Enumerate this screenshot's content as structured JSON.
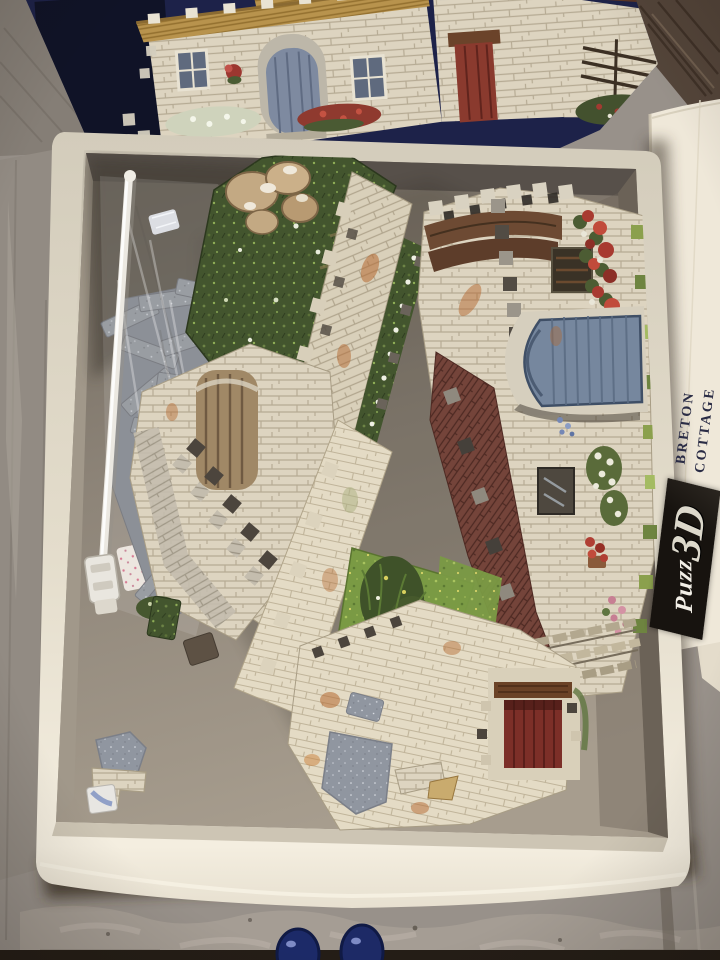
{
  "scene": {
    "description": "Top-down photograph of an opened Puzz 3D 'Breton Cottage' foam jigsaw puzzle box lying on a distressed whitewashed grey wood floor. The dark blue lid with the assembled-cottage artwork lies along the top edge. The open cream box base is filled with part-assembled castellated stone-wall puzzle sections, a clear zip bag of loose grey foam pieces on the left, and scattered pieces; the grey cardboard bottom shows at lower left. A folded instruction sheet rests to the right of the box. Two navy slipper toes peek in at the bottom centre."
  },
  "box": {
    "lid_background_color": "#1c2145",
    "base_rim_color": "#ece5d5",
    "interior_color": "#8e8579",
    "lid_artwork": "white stone Breton cottage with thatched roof, blue arched front door, red side door, shuttered windows, hanging basket and red flower borders on a dark navy background"
  },
  "bag": {
    "description": "clear plastic zip bag with white zip rail and slider, holding loose grey speckled foam pieces"
  },
  "puzzle_pieces": {
    "style": "thick foam 3D pieces with castellated battlement edges",
    "features": [
      "cream stone walls with rust staining",
      "dark green garden with white flowers",
      "pale tan rocks",
      "blue arched door section",
      "dark red plank door with timber lintel",
      "small wooden plank door",
      "bright green lawn",
      "red, white and pink flower borders",
      "grey speckled backing pieces",
      "tall grass tuft"
    ]
  },
  "instruction_sheet": {
    "title_line1": "BRETON",
    "title_line2": "COTTAGE",
    "logo_script": "Puzz",
    "logo_3d": "3D",
    "paper_color": "#efe8d9",
    "text_color": "#2a2c45",
    "logo_bg": "#17130f"
  },
  "floor": {
    "style": "distressed whitewashed planks",
    "main_color": "#98918a",
    "mottle_color": "#b6aea2",
    "dark_corner_wood_color": "#54453a"
  },
  "feet": {
    "description": "two navy blue slipper toes of the photographer",
    "color": "#1d2a66"
  }
}
